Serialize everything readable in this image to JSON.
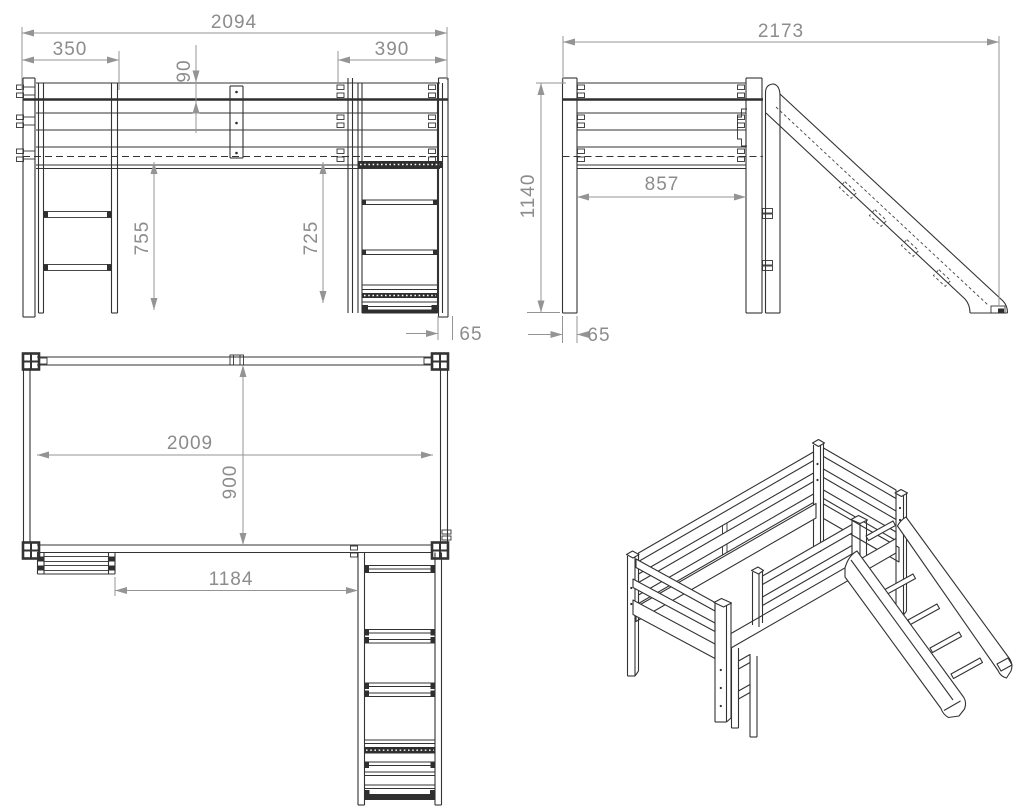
{
  "drawing": {
    "title": "loft bed with slide - technical drawing",
    "views": {
      "front_elevation": {
        "dimensions": {
          "total_width": "2094",
          "ladder_offset": "350",
          "slide_offset": "390",
          "guard_rail_height": "90",
          "underbed_clearance_left": "755",
          "underbed_clearance_right": "725",
          "slide_foot_width": "65"
        }
      },
      "side_elevation": {
        "dimensions": {
          "total_depth_with_slide": "2173",
          "overall_height": "1140",
          "post_clear_span": "857",
          "post_width": "65"
        }
      },
      "top_plan": {
        "dimensions": {
          "inner_length": "2009",
          "inner_width": "900",
          "ladder_to_slide": "1184"
        }
      }
    },
    "colors": {
      "line": "#333333",
      "dimension": "#8f8f8f",
      "background": "#ffffff"
    }
  }
}
